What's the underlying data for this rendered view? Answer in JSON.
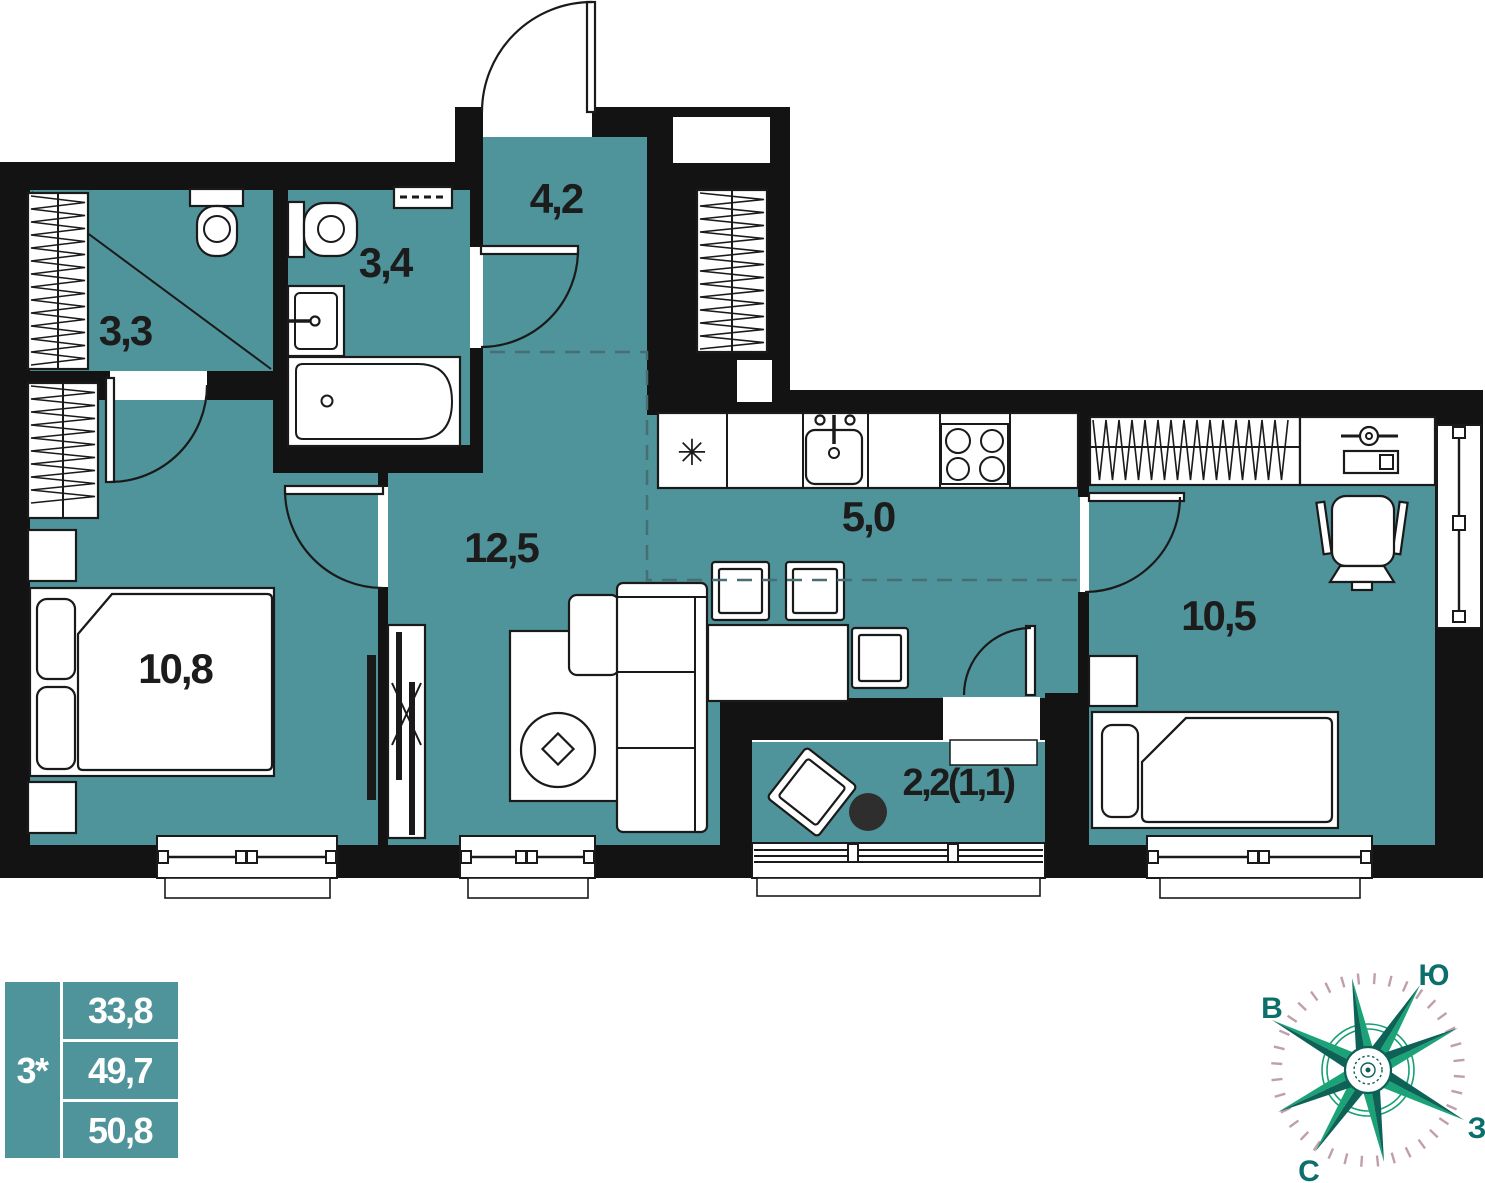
{
  "plan": {
    "rooms": [
      {
        "id": "room-3-3",
        "label": "3,3"
      },
      {
        "id": "room-3-4",
        "label": "3,4"
      },
      {
        "id": "room-4-2",
        "label": "4,2"
      },
      {
        "id": "room-12-5",
        "label": "12,5"
      },
      {
        "id": "room-5-0",
        "label": "5,0"
      },
      {
        "id": "room-10-8",
        "label": "10,8"
      },
      {
        "id": "room-10-5",
        "label": "10,5"
      },
      {
        "id": "balcony",
        "label": "2,2(1,1)"
      }
    ],
    "fridge_symbol": "✳"
  },
  "legend": {
    "type_label": "3*",
    "areas": [
      "33,8",
      "49,7",
      "50,8"
    ]
  },
  "compass": {
    "south": "Ю",
    "north": "С",
    "east": "В",
    "west": "З"
  },
  "colors": {
    "floor_teal": "#4f949a",
    "wall_black": "#131313",
    "compass_green": "#17a074",
    "compass_dark": "#0d6157",
    "tick_pink": "#c09fab",
    "label_dark": "#1c1c1c"
  }
}
